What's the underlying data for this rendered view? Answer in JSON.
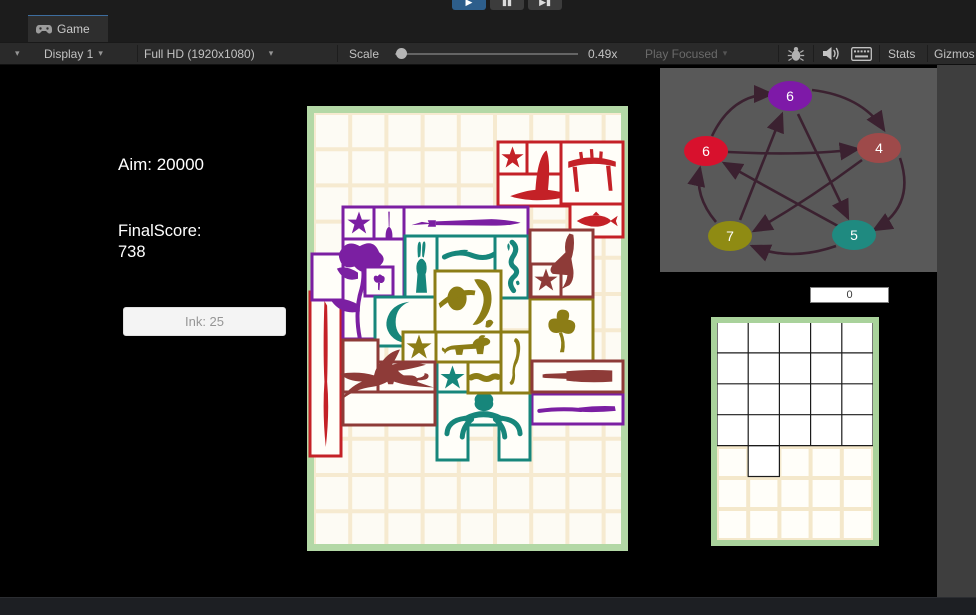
{
  "window": {
    "tab": "Game",
    "display": "Display 1",
    "resolution": "Full HD (1920x1080)",
    "scale_label": "Scale",
    "scale_value": "0.49x",
    "play_mode": "Play Focused",
    "stats_label": "Stats",
    "gizmos_label": "Gizmos",
    "play_icon": "▶",
    "pause_icon": "▮▮",
    "step_icon": "▶▮"
  },
  "hud": {
    "aim": "Aim: 20000",
    "final_label": "FinalScore:",
    "final_value": "738",
    "ink_button": "Ink: 25"
  },
  "mini_input": {
    "value": "0"
  },
  "graph": {
    "x": 660,
    "y": 68,
    "w": 277,
    "h": 204,
    "bg": "#595959",
    "arrow_color": "#3b2130",
    "nodes": [
      {
        "label": "6",
        "x": 130,
        "y": 28,
        "color": "#7e19a8"
      },
      {
        "label": "6",
        "x": 46,
        "y": 83,
        "color": "#d8112d"
      },
      {
        "label": "4",
        "x": 219,
        "y": 80,
        "color": "#9e4a4a"
      },
      {
        "label": "7",
        "x": 70,
        "y": 168,
        "color": "#8f8b13"
      },
      {
        "label": "5",
        "x": 194,
        "y": 167,
        "color": "#1f8a80"
      }
    ],
    "edges": [
      "M52 68 Q72 26 112 26",
      "M152 22 Q202 28 224 62",
      "M240 90 Q256 138 214 162",
      "M176 178 Q130 194 92 178",
      "M56 154 Q34 128 40 100",
      "M68 84 Q145 88 198 81",
      "M202 92 Q148 132 94 163",
      "M80 152 Q104 92 122 46",
      "M138 46 Q166 104 188 150",
      "M178 158 Q112 122 64 95"
    ]
  },
  "main_board": {
    "x": 307,
    "y": 106,
    "w": 321,
    "h": 445,
    "border_color": "#b3d8a6",
    "bg": "#fdfbf4",
    "grid_color": "#f6ead0",
    "cell": 36.2,
    "pad": 7,
    "piece_fill": "#fffef9",
    "pieces": [
      {
        "c": "#c42127",
        "boxes": [
          [
            498,
            142,
            29,
            32
          ],
          [
            527,
            142,
            34,
            32
          ],
          [
            498,
            174,
            81,
            32
          ]
        ],
        "glyphs": [
          [
            "star",
            501,
            146,
            23,
            23
          ],
          [
            "hat",
            506,
            146,
            70,
            57
          ]
        ]
      },
      {
        "c": "#c42127",
        "boxes": [
          [
            561,
            142,
            62,
            62
          ]
        ],
        "glyphs": [
          [
            "table",
            565,
            146,
            54,
            52
          ]
        ]
      },
      {
        "c": "#c42127",
        "boxes": [
          [
            570,
            204,
            53,
            33
          ]
        ],
        "glyphs": [
          [
            "fish",
            575,
            208,
            44,
            26
          ]
        ]
      },
      {
        "c": "#c42127",
        "boxes": [
          [
            310,
            292,
            31,
            164
          ]
        ],
        "glyphs": [
          [
            "brushv",
            312,
            298,
            27,
            152
          ]
        ]
      },
      {
        "c": "#7b1fa2",
        "boxes": [
          [
            343,
            207,
            31,
            33
          ]
        ],
        "glyphs": [
          [
            "star",
            347,
            211,
            24,
            24
          ]
        ]
      },
      {
        "c": "#7b1fa2",
        "boxes": [
          [
            374,
            207,
            30,
            62
          ]
        ],
        "glyphs": [
          [
            "dart",
            377,
            210,
            24,
            56
          ]
        ]
      },
      {
        "c": "#7b1fa2",
        "boxes": [
          [
            404,
            207,
            124,
            33
          ]
        ],
        "glyphs": [
          [
            "swordh",
            408,
            210,
            116,
            27
          ]
        ]
      },
      {
        "c": "#7b1fa2",
        "boxes": [
          [
            343,
            239,
            61,
            100
          ],
          [
            312,
            254,
            31,
            46
          ]
        ],
        "glyphs": [
          [
            "flower",
            314,
            238,
            88,
            102
          ]
        ]
      },
      {
        "c": "#7b1fa2",
        "boxes": [
          [
            365,
            267,
            28,
            29
          ]
        ],
        "glyphs": [
          [
            "flower2",
            367,
            269,
            24,
            26
          ]
        ]
      },
      {
        "c": "#7b1fa2",
        "boxes": [
          [
            532,
            394,
            91,
            30
          ]
        ],
        "glyphs": [
          [
            "broom",
            536,
            398,
            83,
            23
          ]
        ]
      },
      {
        "c": "#17867b",
        "boxes": [
          [
            405,
            236,
            32,
            62
          ]
        ],
        "glyphs": [
          [
            "rabbit",
            409,
            240,
            25,
            55
          ]
        ]
      },
      {
        "c": "#17867b",
        "boxes": [
          [
            437,
            236,
            93,
            35
          ]
        ],
        "glyphs": [
          [
            "vine",
            441,
            239,
            85,
            29
          ]
        ]
      },
      {
        "c": "#17867b",
        "boxes": [
          [
            495,
            236,
            33,
            62
          ]
        ],
        "glyphs": [
          [
            "curly",
            498,
            240,
            27,
            55
          ]
        ]
      },
      {
        "c": "#17867b",
        "boxes": [
          [
            375,
            297,
            62,
            49
          ]
        ],
        "glyphs": [
          [
            "moon",
            380,
            299,
            46,
            46
          ]
        ]
      },
      {
        "c": "#17867b",
        "boxes": [
          [
            437,
            362,
            31,
            31
          ]
        ],
        "glyphs": [
          [
            "star",
            440,
            365,
            25,
            25
          ]
        ]
      },
      {
        "c": "#17867b",
        "poly": [
          [
            437,
            392
          ],
          [
            530,
            392
          ],
          [
            530,
            460
          ],
          [
            499,
            460
          ],
          [
            499,
            425
          ],
          [
            468,
            425
          ],
          [
            468,
            460
          ],
          [
            437,
            460
          ]
        ],
        "glyphs": [
          [
            "spider",
            441,
            393,
            85,
            55
          ]
        ]
      },
      {
        "c": "#8c7d16",
        "boxes": [
          [
            435,
            271,
            66,
            61
          ]
        ],
        "glyphs": [
          [
            "planet",
            437,
            275,
            40,
            46
          ],
          [
            "banana",
            463,
            276,
            40,
            58
          ]
        ]
      },
      {
        "c": "#8c7d16",
        "boxes": [
          [
            403,
            332,
            33,
            30
          ],
          [
            436,
            332,
            65,
            30
          ]
        ],
        "glyphs": [
          [
            "star",
            406,
            334,
            26,
            26
          ],
          [
            "dog",
            439,
            329,
            58,
            34
          ]
        ]
      },
      {
        "c": "#8c7d16",
        "boxes": [
          [
            501,
            332,
            29,
            61
          ]
        ],
        "glyphs": [
          [
            "cobra",
            503,
            336,
            25,
            54
          ]
        ]
      },
      {
        "c": "#8c7d16",
        "boxes": [
          [
            468,
            362,
            33,
            31
          ]
        ],
        "glyphs": [
          [
            "snake",
            470,
            370,
            29,
            15
          ]
        ]
      },
      {
        "c": "#8c7d16",
        "boxes": [
          [
            530,
            299,
            63,
            63
          ]
        ],
        "glyphs": [
          [
            "clover",
            536,
            303,
            52,
            56
          ]
        ]
      },
      {
        "c": "#8e3b38",
        "boxes": [
          [
            530,
            230,
            63,
            67
          ],
          [
            531,
            264,
            30,
            33
          ]
        ],
        "glyphs": [
          [
            "bird",
            541,
            231,
            49,
            63
          ],
          [
            "star",
            534,
            268,
            24,
            24
          ]
        ]
      },
      {
        "c": "#8e3b38",
        "boxes": [
          [
            375,
            362,
            60,
            30
          ]
        ],
        "glyphs": [
          [
            "cat",
            378,
            363,
            54,
            28
          ]
        ]
      },
      {
        "c": "#8e3b38",
        "boxes": [
          [
            343,
            340,
            35,
            85
          ],
          [
            343,
            392,
            92,
            33
          ]
        ],
        "glyphs": [
          [
            "eagle",
            338,
            348,
            100,
            76
          ]
        ]
      },
      {
        "c": "#8e3b38",
        "boxes": [
          [
            532,
            361,
            91,
            31
          ]
        ],
        "glyphs": [
          [
            "bottle",
            538,
            364,
            79,
            26
          ]
        ]
      }
    ]
  },
  "tracking_board": {
    "x": 711,
    "y": 317,
    "w": 168,
    "h": 229,
    "border_color": "#a9d29b",
    "bg": "#fffef9",
    "grid_color": "#f4e8cb",
    "cols": 5,
    "rows": 7,
    "black": {
      "x": 717,
      "y": 322,
      "cols": 5,
      "rows": 4,
      "cw": 31.2,
      "rh": 30.9,
      "extra_cells": [
        [
          1,
          4
        ]
      ],
      "color": "#1b1b1b"
    }
  }
}
